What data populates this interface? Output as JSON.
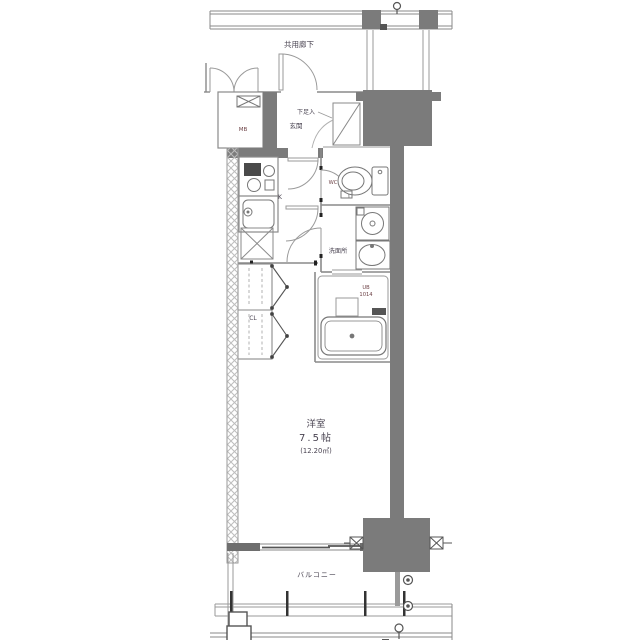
{
  "plan": {
    "common_corridor": "共用廊下",
    "entrance": "玄関",
    "shoe_cabinet": "下足入",
    "meter_box": "MB",
    "toilet": "WC",
    "kitchen": "K",
    "washroom": "洗面所",
    "unit_bath_label": "UB",
    "unit_bath_size": "1014",
    "closet": "CL",
    "main_room": {
      "name": "洋室",
      "size": "7.5帖",
      "area": "(12.20㎡)"
    },
    "balcony": "バルコニー"
  },
  "colors": {
    "background": "#ffffff",
    "structure_fill": "#7b7b7b",
    "thin_line": "#8a8a8a",
    "wall_line": "#777777",
    "room_label": "#4a4452",
    "fixture_label": "#6e4347"
  }
}
